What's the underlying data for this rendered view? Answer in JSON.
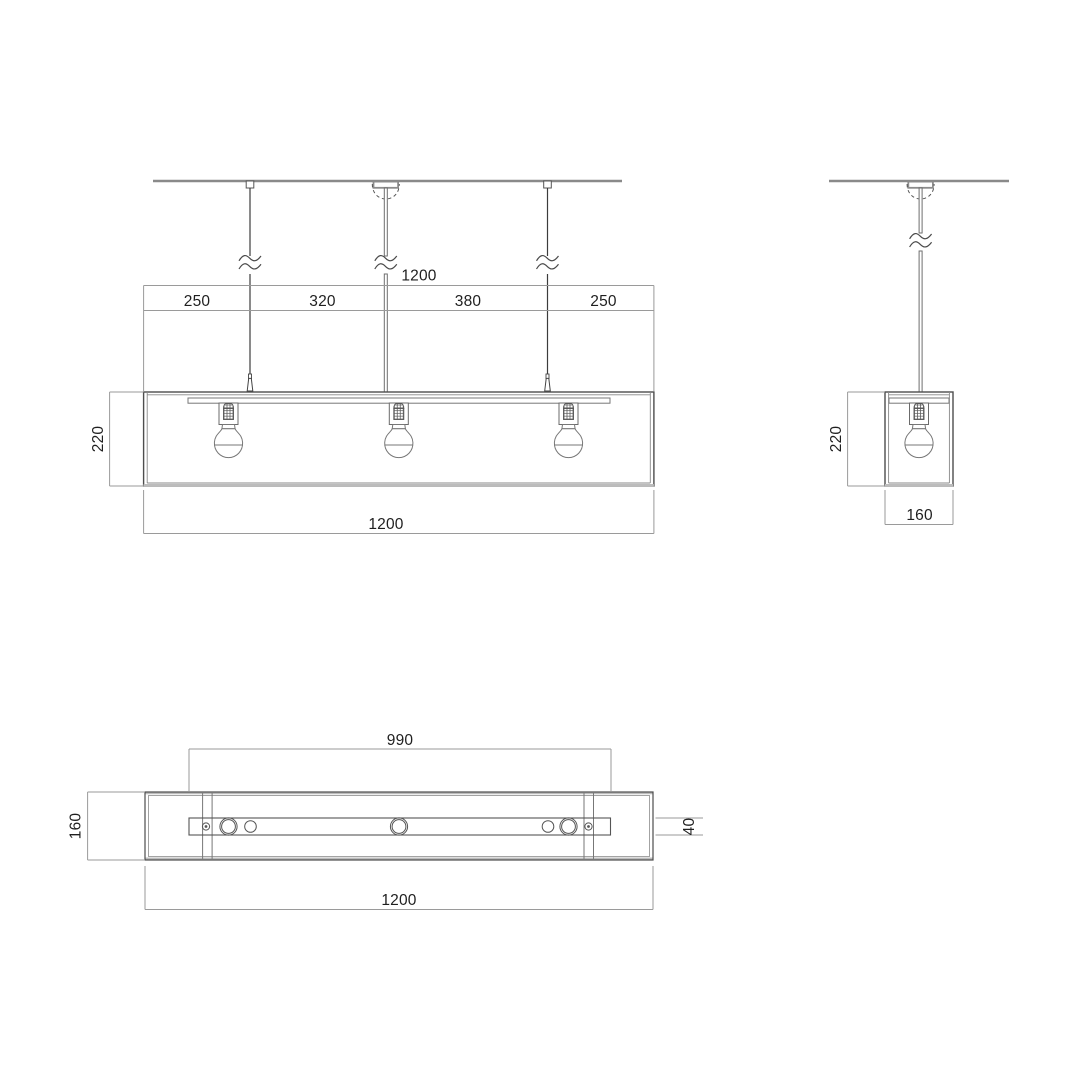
{
  "drawing": {
    "type": "pendant-lamp-technical-drawing",
    "colors": {
      "object_line": "#4d4d4d",
      "detail_line": "#777777",
      "dimension_line": "#9a9a9a",
      "thick_edge": "#bcbcbc",
      "text": "#1f1f1f",
      "background": "#ffffff"
    },
    "front_view": {
      "dim_overall_top": "1200",
      "dim_segments": [
        "250",
        "320",
        "380",
        "250"
      ],
      "dim_height": "220",
      "dim_overall_bottom": "1200"
    },
    "side_view": {
      "dim_height": "220",
      "dim_width": "160"
    },
    "plan_view": {
      "dim_plate_length": "990",
      "dim_depth": "160",
      "dim_plate_width": "40",
      "dim_overall": "1200"
    }
  }
}
